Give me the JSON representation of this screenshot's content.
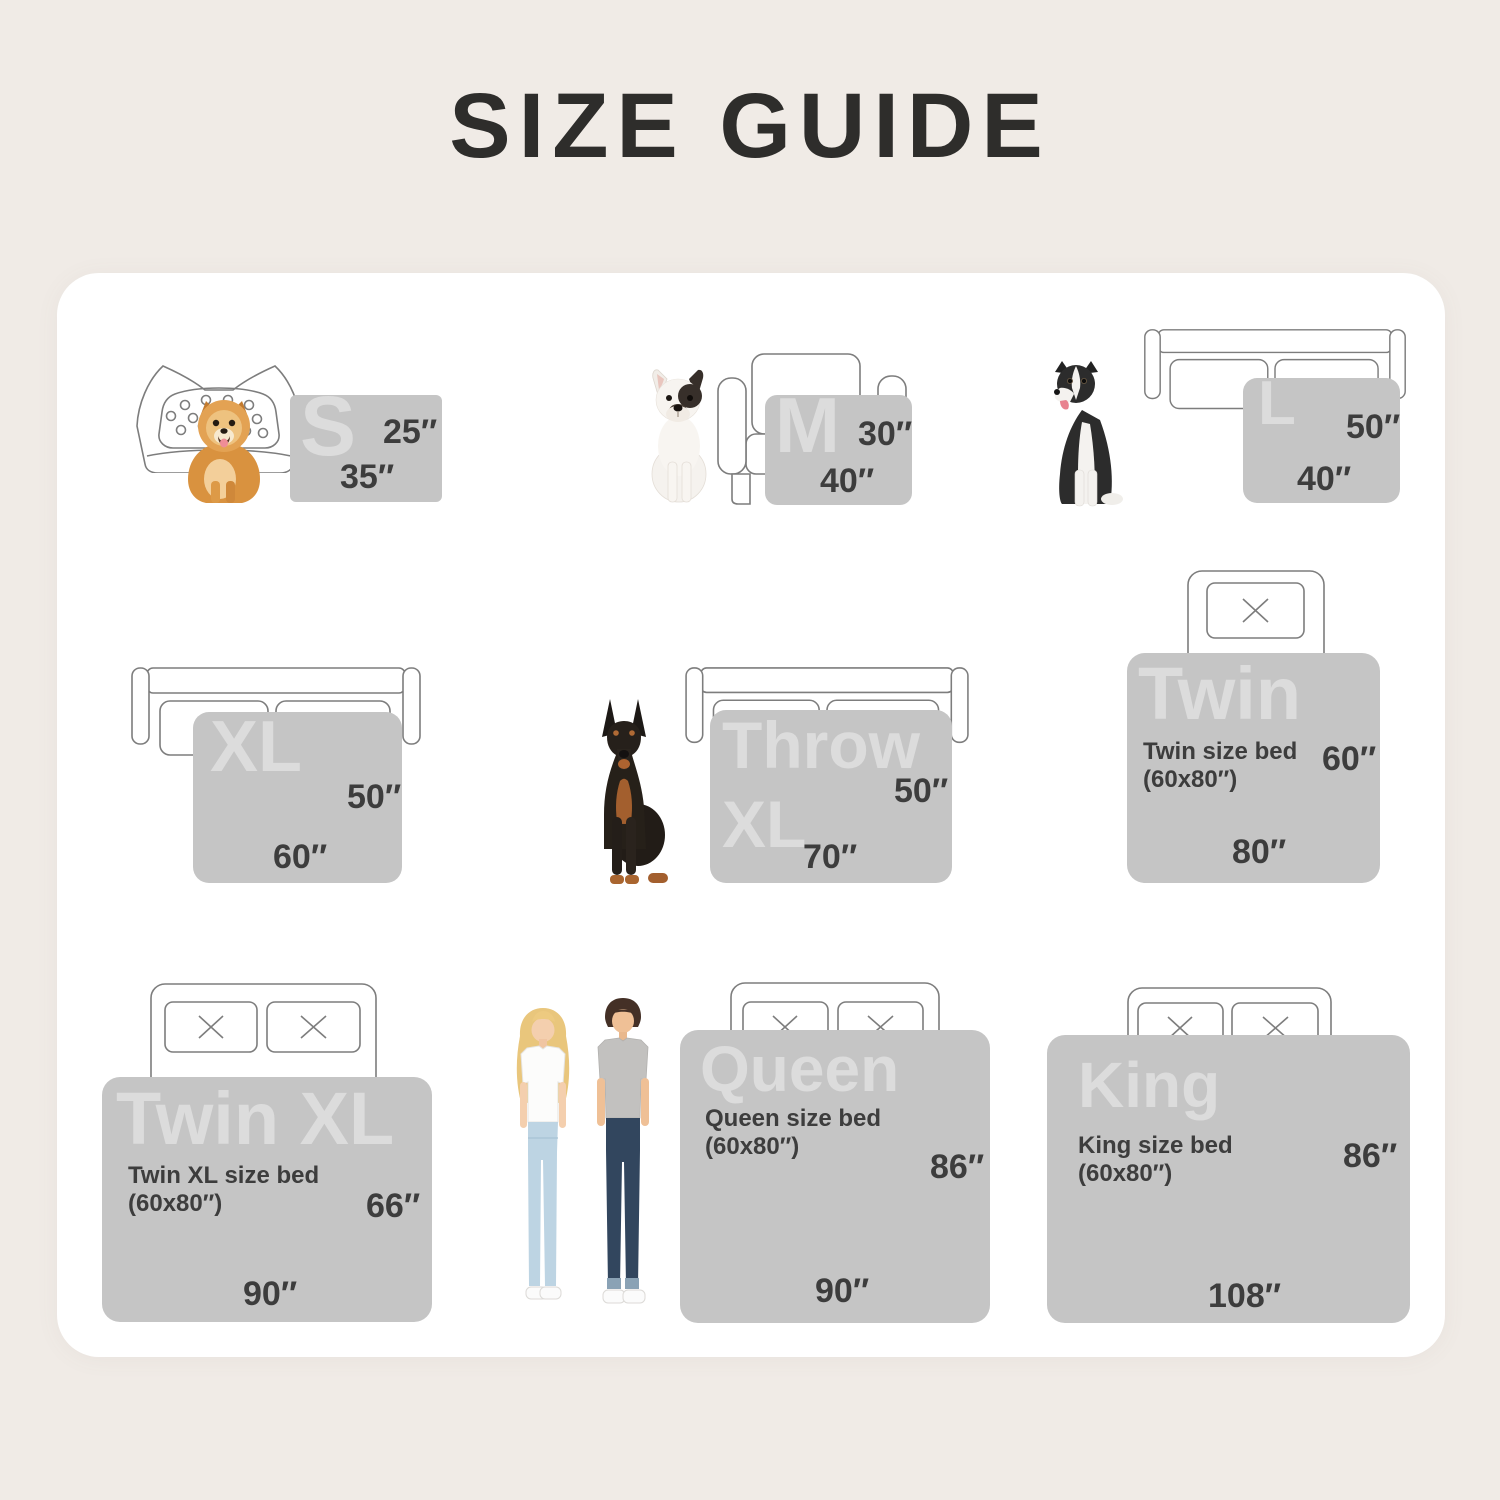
{
  "title": "SIZE GUIDE",
  "colors": {
    "background": "#f0ebe6",
    "card": "#ffffff",
    "swatch": "#c5c5c5",
    "swatch_label": "#dcdcdc",
    "text_dark": "#3d3d3d",
    "outline": "#7d7d7d"
  },
  "cells": [
    {
      "key": "s",
      "badge": "S",
      "side": "25″",
      "bottom": "35″",
      "companion": "pomeranian-dog",
      "furniture": "pet-bed"
    },
    {
      "key": "m",
      "badge": "M",
      "side": "30″",
      "bottom": "40″",
      "companion": "french-bulldog",
      "furniture": "armchair"
    },
    {
      "key": "l",
      "badge": "L",
      "side": "50″",
      "bottom": "40″",
      "companion": "border-collie-dog",
      "furniture": "sofa"
    },
    {
      "key": "xl",
      "badge": "XL",
      "side": "50″",
      "bottom": "60″",
      "companion": "",
      "furniture": "sofa"
    },
    {
      "key": "throw-xl",
      "badge_line1": "Throw",
      "badge_line2": "XL",
      "side": "50″",
      "bottom": "70″",
      "companion": "doberman-dog",
      "furniture": "sofa"
    },
    {
      "key": "twin",
      "badge": "Twin",
      "desc_line1": "Twin size bed",
      "desc_line2": "(60x80″)",
      "side": "60″",
      "bottom": "80″",
      "companion": "",
      "furniture": "bed-one-pillow"
    },
    {
      "key": "twin-xl",
      "badge": "Twin XL",
      "desc_line1": "Twin XL size bed",
      "desc_line2": "(60x80″)",
      "side": "66″",
      "bottom": "90″",
      "companion": "",
      "furniture": "bed-two-pillows"
    },
    {
      "key": "queen",
      "badge": "Queen",
      "desc_line1": "Queen size bed",
      "desc_line2": "(60x80″)",
      "side": "86″",
      "bottom": "90″",
      "companion": "man-and-woman",
      "furniture": "bed-two-pillows"
    },
    {
      "key": "king",
      "badge": "King",
      "desc_line1": "King size bed",
      "desc_line2": "(60x80″)",
      "side": "86″",
      "bottom": "108″",
      "companion": "",
      "furniture": "bed-two-pillows"
    }
  ]
}
